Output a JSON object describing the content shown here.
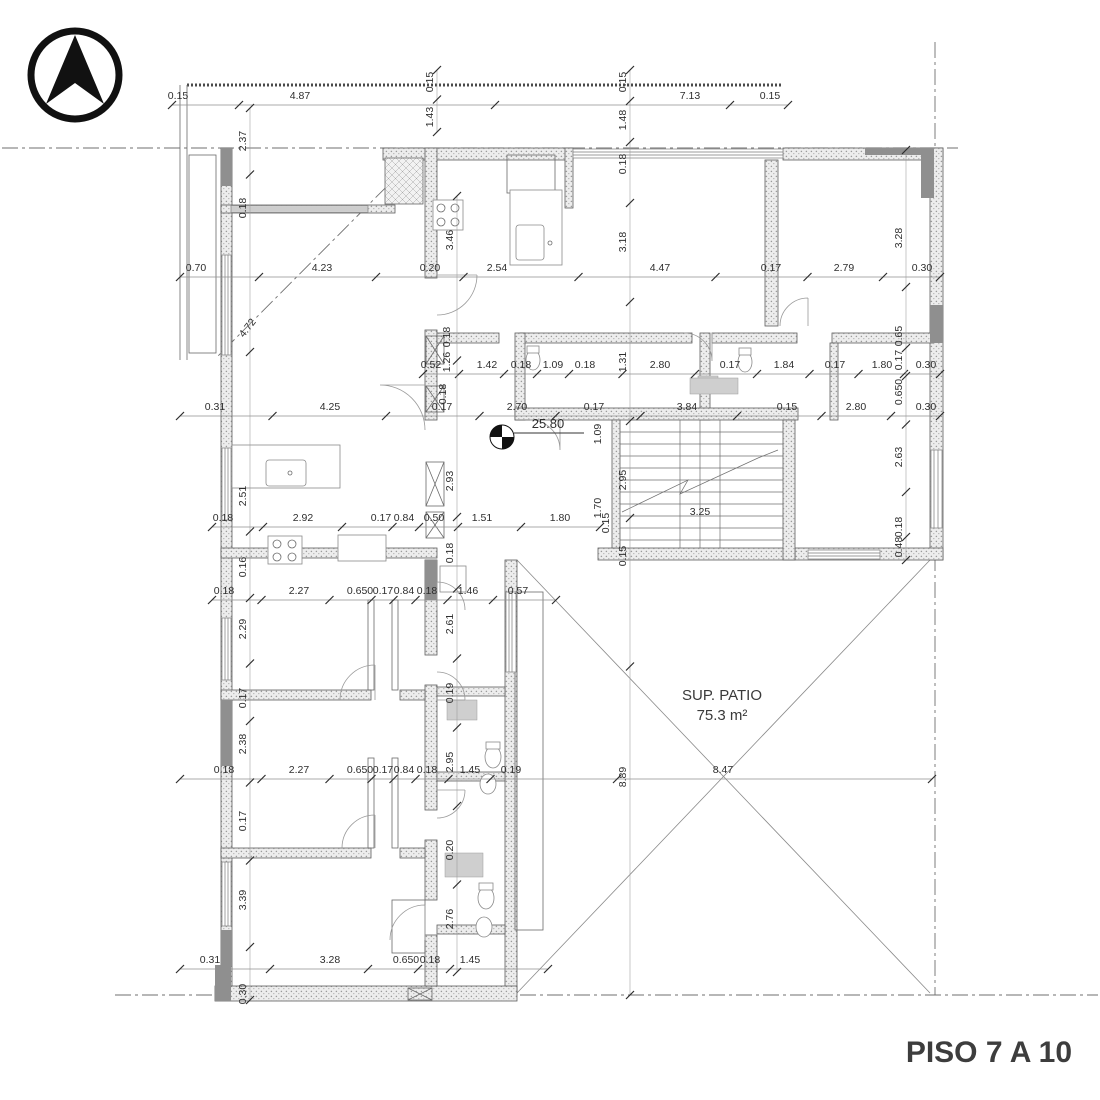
{
  "title": "PISO 7 A 10",
  "patio": {
    "line1": "SUP. PATIO",
    "line2": "75.3 m²"
  },
  "benchmark": {
    "value": "25.80"
  },
  "north_arrow": "north-arrow",
  "colors": {
    "wall_fill": "#ebebeb",
    "wall_dot": "#999999",
    "dark_wall": "#8f8f8f",
    "dim_text": "#2e2e2e",
    "title_text": "#3d3d3d",
    "line": "#6a6a6a"
  },
  "dim_rows": [
    {
      "y": 99,
      "x1": 172,
      "x2": 788,
      "labels": [
        {
          "t": "0.15",
          "x": 178
        },
        {
          "t": "4.87",
          "x": 300
        },
        {
          "t": "7.13",
          "x": 690
        },
        {
          "t": "0.15",
          "x": 770
        }
      ]
    },
    {
      "y": 271,
      "x1": 180,
      "x2": 940,
      "labels": [
        {
          "t": "0.70",
          "x": 196
        },
        {
          "t": "4.23",
          "x": 322
        },
        {
          "t": "0.20",
          "x": 430
        },
        {
          "t": "2.54",
          "x": 497
        },
        {
          "t": "4.47",
          "x": 660
        },
        {
          "t": "0.17",
          "x": 771
        },
        {
          "t": "2.79",
          "x": 844
        },
        {
          "t": "0.30",
          "x": 922
        }
      ]
    },
    {
      "y": 368,
      "x1": 423,
      "x2": 940,
      "labels": [
        {
          "t": "0.52",
          "x": 431
        },
        {
          "t": "1.42",
          "x": 487
        },
        {
          "t": "0.18",
          "x": 521
        },
        {
          "t": "1.09",
          "x": 553
        },
        {
          "t": "0.18",
          "x": 585
        },
        {
          "t": "2.80",
          "x": 660
        },
        {
          "t": "0.17",
          "x": 730
        },
        {
          "t": "1.84",
          "x": 784
        },
        {
          "t": "0.17",
          "x": 835
        },
        {
          "t": "1.80",
          "x": 882
        },
        {
          "t": "0.30",
          "x": 926
        }
      ]
    },
    {
      "y": 410,
      "x1": 180,
      "x2": 940,
      "labels": [
        {
          "t": "0.31",
          "x": 215
        },
        {
          "t": "4.25",
          "x": 330
        },
        {
          "t": "0.17",
          "x": 442
        },
        {
          "t": "2.70",
          "x": 517
        },
        {
          "t": "0.17",
          "x": 594
        },
        {
          "t": "3.84",
          "x": 687
        },
        {
          "t": "0.15",
          "x": 787
        },
        {
          "t": "2.80",
          "x": 856
        },
        {
          "t": "0.30",
          "x": 926
        }
      ]
    },
    {
      "y": 521,
      "x1": 212,
      "x2": 600,
      "labels": [
        {
          "t": "0.18",
          "x": 223
        },
        {
          "t": "2.92",
          "x": 303
        },
        {
          "t": "0.17",
          "x": 381
        },
        {
          "t": "0.84",
          "x": 404
        },
        {
          "t": "0.50",
          "x": 434
        },
        {
          "t": "1.51",
          "x": 482
        },
        {
          "t": "1.80",
          "x": 560
        }
      ]
    },
    {
      "y": 594,
      "x1": 212,
      "x2": 556,
      "labels": [
        {
          "t": "0.18",
          "x": 224
        },
        {
          "t": "2.27",
          "x": 299
        },
        {
          "t": "0.650",
          "x": 360
        },
        {
          "t": "0.17",
          "x": 383
        },
        {
          "t": "0.84",
          "x": 404
        },
        {
          "t": "0.18",
          "x": 427
        },
        {
          "t": "1.46",
          "x": 468
        },
        {
          "t": "0.57",
          "x": 518
        }
      ]
    },
    {
      "y": 773,
      "x1": 180,
      "x2": 932,
      "labels": [
        {
          "t": "0.18",
          "x": 224
        },
        {
          "t": "2.27",
          "x": 299
        },
        {
          "t": "0.650",
          "x": 360
        },
        {
          "t": "0.17",
          "x": 383
        },
        {
          "t": "0.84",
          "x": 404
        },
        {
          "t": "0.18",
          "x": 427
        },
        {
          "t": "1.45",
          "x": 470
        },
        {
          "t": "0.19",
          "x": 511
        },
        {
          "t": "8.47",
          "x": 723
        }
      ]
    },
    {
      "y": 963,
      "x1": 180,
      "x2": 548,
      "labels": [
        {
          "t": "0.31",
          "x": 210
        },
        {
          "t": "3.28",
          "x": 330
        },
        {
          "t": "0.650",
          "x": 406
        },
        {
          "t": "0.18",
          "x": 430
        },
        {
          "t": "1.45",
          "x": 470
        }
      ]
    }
  ],
  "dim_cols": [
    {
      "x": 246,
      "y1": 108,
      "y2": 1000,
      "labels": [
        {
          "t": "2.37",
          "y": 141
        },
        {
          "t": "0.18",
          "y": 208
        },
        {
          "t": "2.51",
          "y": 496
        },
        {
          "t": "0.16",
          "y": 567
        },
        {
          "t": "2.29",
          "y": 629
        },
        {
          "t": "0.17",
          "y": 698
        },
        {
          "t": "2.38",
          "y": 744
        },
        {
          "t": "0.17",
          "y": 821
        },
        {
          "t": "3.39",
          "y": 900
        },
        {
          "t": "0.30",
          "y": 994
        }
      ]
    },
    {
      "x": 453,
      "y1": 196,
      "y2": 972,
      "labels": [
        {
          "t": "3.46",
          "y": 240
        },
        {
          "t": "2.93",
          "y": 481
        },
        {
          "t": "0.18",
          "y": 553
        },
        {
          "t": "2.61",
          "y": 624
        },
        {
          "t": "0.19",
          "y": 693
        },
        {
          "t": "2.95",
          "y": 762
        },
        {
          "t": "0.20",
          "y": 850
        },
        {
          "t": "2.76",
          "y": 919
        }
      ]
    },
    {
      "x": 433,
      "y1": 70,
      "y2": 132,
      "labels": [
        {
          "t": "0.15",
          "y": 82
        },
        {
          "t": "1.43",
          "y": 117
        }
      ]
    },
    {
      "x": 626,
      "y1": 70,
      "y2": 995,
      "labels": [
        {
          "t": "0.15",
          "y": 82
        },
        {
          "t": "1.48",
          "y": 120
        },
        {
          "t": "0.18",
          "y": 164
        },
        {
          "t": "3.18",
          "y": 242
        },
        {
          "t": "1.31",
          "y": 362
        },
        {
          "t": "2.95",
          "y": 480
        },
        {
          "t": "0.15",
          "y": 556
        },
        {
          "t": "8.89",
          "y": 777
        }
      ]
    },
    {
      "x": 902,
      "y1": 150,
      "y2": 560,
      "labels": [
        {
          "t": "3.28",
          "y": 238
        },
        {
          "t": "0.65",
          "y": 336
        },
        {
          "t": "0.17",
          "y": 360
        },
        {
          "t": "0.650",
          "y": 392
        },
        {
          "t": "2.63",
          "y": 457
        },
        {
          "t": "0.18",
          "y": 527
        },
        {
          "t": "0.48",
          "y": 547
        }
      ]
    }
  ],
  "free_labels": [
    {
      "t": "4.72",
      "x": 250,
      "y": 330,
      "rot": -52
    },
    {
      "t": "1.26",
      "x": 450,
      "y": 362,
      "rot": -90
    },
    {
      "t": "0.18",
      "x": 450,
      "y": 337,
      "rot": -90
    },
    {
      "t": "0.18",
      "x": 446,
      "y": 394,
      "rot": -90
    },
    {
      "t": "1.09",
      "x": 601,
      "y": 434,
      "rot": -90
    },
    {
      "t": "1.70",
      "x": 601,
      "y": 508,
      "rot": -90
    },
    {
      "t": "0.15",
      "x": 609,
      "y": 523,
      "rot": -90
    },
    {
      "t": "3.25",
      "x": 700,
      "y": 515,
      "rot": 0
    }
  ]
}
